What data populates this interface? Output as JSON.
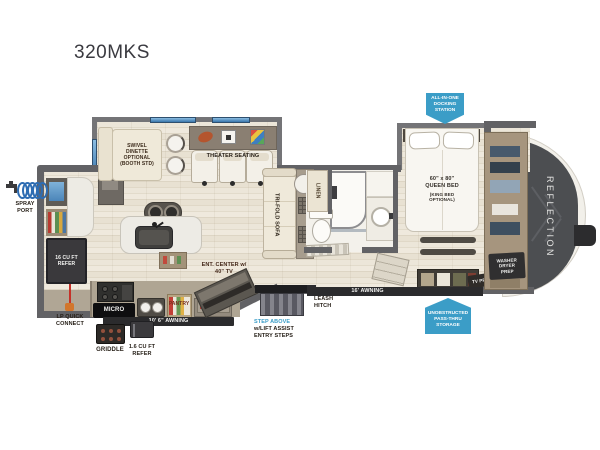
{
  "title": "320MKS",
  "brand": "REFLECTION",
  "accent_blue": "#3b9dc7",
  "wall_color": "#626265",
  "callouts": {
    "docking_station": "ALL-IN-ONE\nDOCKING\nSTATION",
    "pass_thru_storage": "UNOBSTRUCTED\nPASS-THRU\nSTORAGE",
    "spray_port": "SPRAY\nPORT",
    "lp_quick_connect": "LP QUICK\nCONNECT",
    "griddle": "GRIDDLE",
    "outdoor_refer": "1.6 CU FT\nREFER",
    "door_awning": "10' 6\" AWNING",
    "main_awning": "16' AWNING",
    "step_above": "STEP ABOVE",
    "step_above_detail": "w/LIFT ASSIST\nENTRY STEPS",
    "leash_hitch": "LEASH\nHITCH",
    "ent_center": "ENT. CENTER w/\n40\" TV"
  },
  "features": {
    "swivel_dinette": "SWIVEL\nDINETTE\nOPTIONAL\n(BOOTH STD)",
    "theater_seating": "THEATER SEATING",
    "tri_fold_sofa": "TRI-FOLD SOFA",
    "linen": "LINEN",
    "pantry": "PANTRY",
    "micro": "MICRO",
    "refer": "16 CU FT\nREFER",
    "queen_bed": "60\" x 80\"\nQUEEN BED",
    "king_bed_option": "(KING BED\nOPTIONAL)",
    "washer_dryer_prep": "WASHER\nDRYER\nPREP",
    "tv_prep": "TV PREP"
  }
}
